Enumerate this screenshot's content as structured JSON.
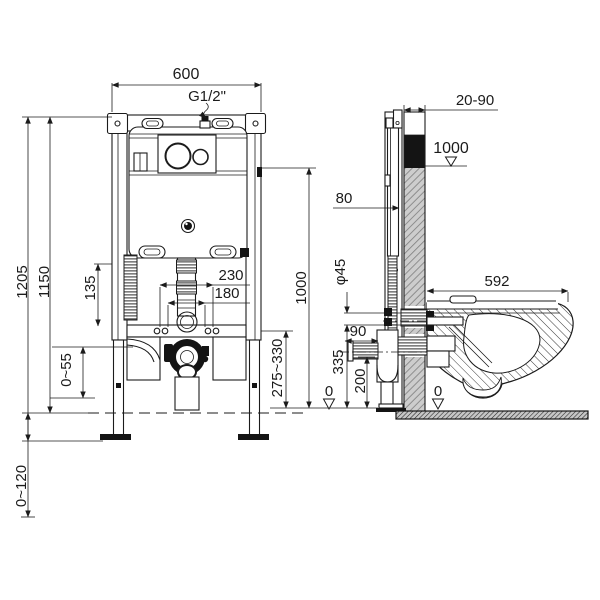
{
  "diagram": {
    "name": "Concealed cistern frame and wall-hung toilet installation drawing",
    "front": {
      "width": "600",
      "inlet": "G1/2\"",
      "h_total": "1205",
      "h_frame": "1150",
      "d135": "135",
      "d055": "0~55",
      "d0120": "0~120",
      "d230": "230",
      "d180": "180",
      "d1000": "1000",
      "d275": "275~330",
      "zero": "0"
    },
    "side": {
      "wall": "20-90",
      "level": "1000",
      "d80": "80",
      "dia": "φ45",
      "d90": "90",
      "d335": "335",
      "d200": "200",
      "depth": "592",
      "zero": "0"
    },
    "colors": {
      "line": "#1b1b1b",
      "wall_fill": "#cdcdcd",
      "black_zone": "#141414",
      "background": "#ffffff"
    }
  }
}
